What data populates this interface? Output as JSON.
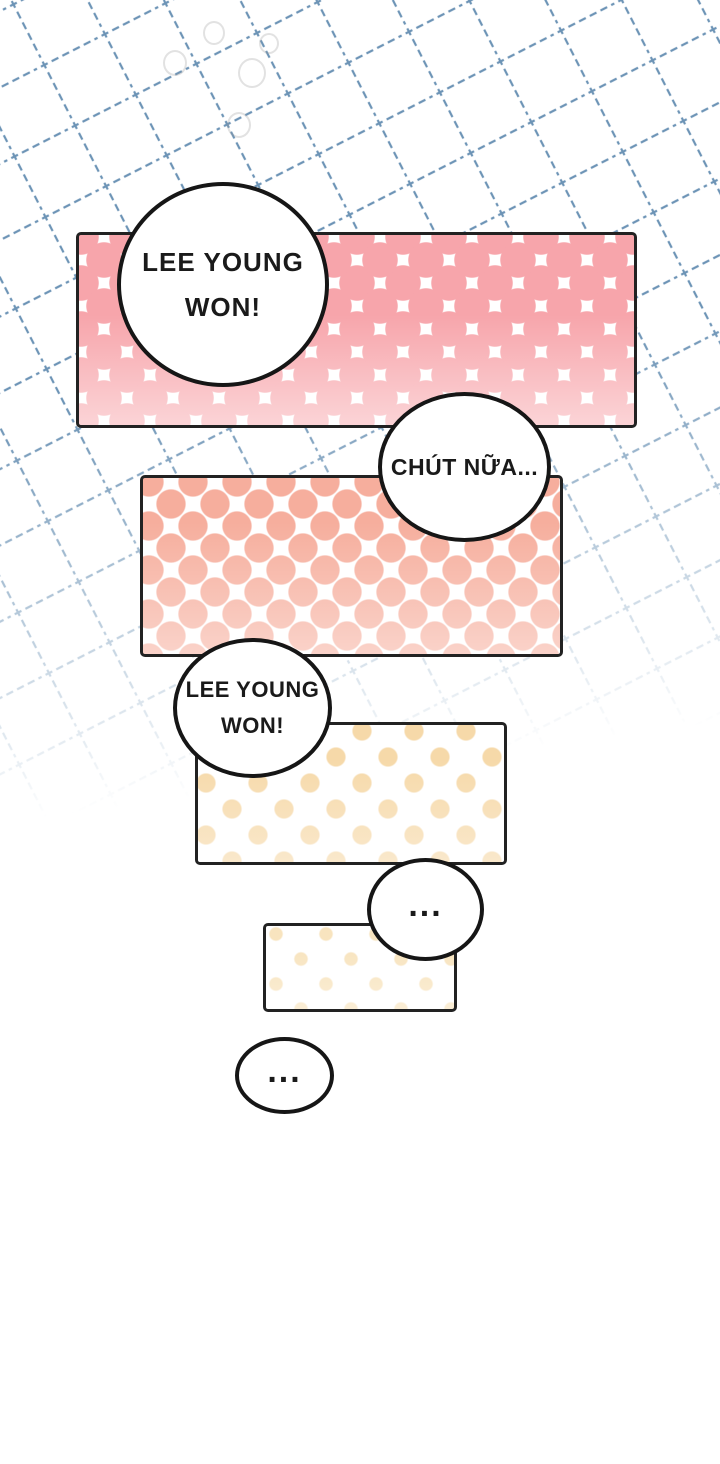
{
  "page": {
    "background_color": "#ffffff",
    "grid": {
      "line_color": "#6d94b6",
      "style": "dashed",
      "cell_size_px": 68,
      "rotation_deg": -27,
      "fade": "fades to white toward bottom of upper half"
    }
  },
  "panels": [
    {
      "label": "panel-1",
      "dot_color": "#f7a5ab"
    },
    {
      "label": "panel-2",
      "dot_color": "#f6ae9d"
    },
    {
      "label": "panel-3",
      "dot_color": "#f6d9a9"
    },
    {
      "label": "panel-4",
      "dot_color": "#f8e4bf"
    }
  ],
  "bubbles": [
    {
      "label": "bubble-1",
      "lines": [
        "LEE YOUNG",
        "WON!"
      ]
    },
    {
      "label": "bubble-2",
      "lines": [
        "CHÚT NỮA..."
      ]
    },
    {
      "label": "bubble-3",
      "lines": [
        "LEE YOUNG",
        "WON!"
      ]
    },
    {
      "label": "bubble-4",
      "lines": [
        "..."
      ]
    },
    {
      "label": "bubble-5",
      "lines": [
        "..."
      ]
    }
  ]
}
